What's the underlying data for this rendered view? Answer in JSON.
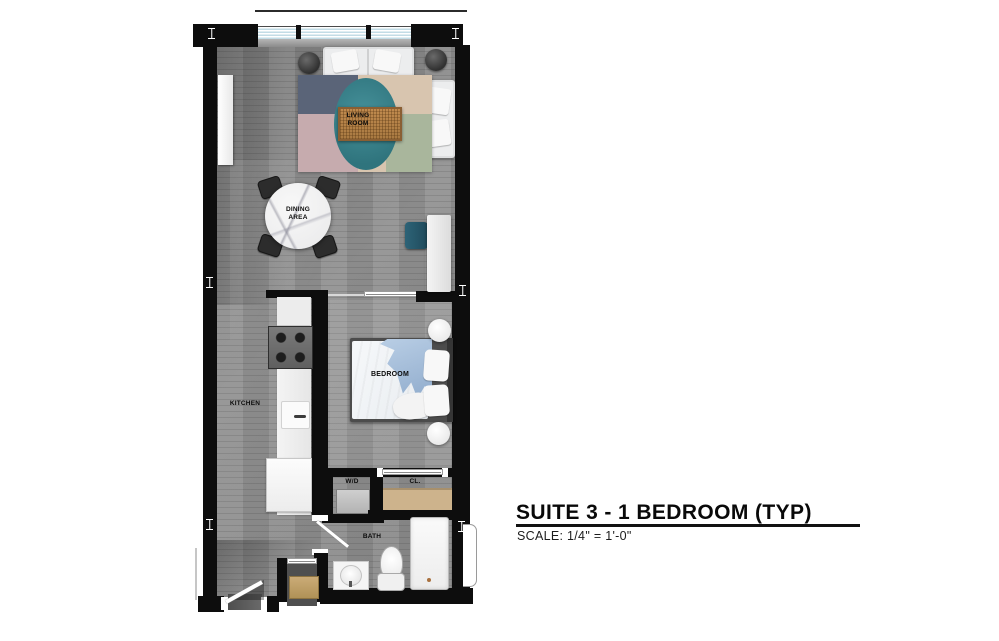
{
  "title_block": {
    "title": "SUITE 3 - 1 BEDROOM (TYP)",
    "scale": "SCALE: 1/4\" = 1'-0\""
  },
  "room_labels": {
    "living_room": "LIVING ROOM",
    "dining_area": "DINING AREA",
    "kitchen": "KITCHEN",
    "bedroom": "BEDROOM",
    "washer_dryer": "W/D",
    "closet": "CL.",
    "bath": "BATH"
  },
  "colors": {
    "wall": "#0d0d0d",
    "floor_gray": "#8f8f8f",
    "window_glass": "#c2dce6",
    "rug_navy": "#5a6478",
    "rug_mauve": "#c6abae",
    "rug_tan": "#d8c5af",
    "rug_sage": "#a9b69c",
    "rug_teal": "#367e87",
    "coffee_table_wood": "#b9854e",
    "desk_chair_teal": "#2d6377",
    "closet_shelf_tan": "#cdb38c",
    "bed_blanket_blue": "#a9c3dc"
  }
}
